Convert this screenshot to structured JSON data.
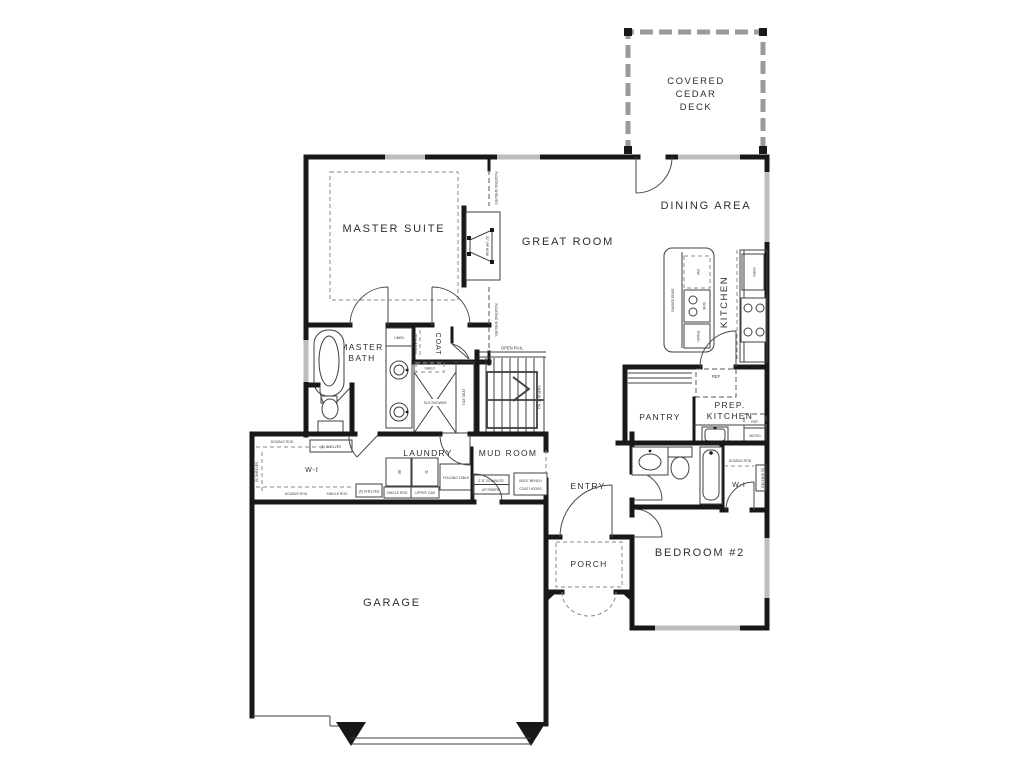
{
  "plan": {
    "rooms": {
      "deck": {
        "lines": [
          "COVERED",
          "CEDAR",
          "DECK"
        ]
      },
      "dining": {
        "label": "DINING AREA"
      },
      "great_room": {
        "label": "GREAT ROOM"
      },
      "master_suite": {
        "label": "MASTER SUITE"
      },
      "kitchen": {
        "label": "KITCHEN"
      },
      "prep_kitchen": {
        "lines": [
          "PREP.",
          "KITCHEN"
        ]
      },
      "pantry": {
        "label": "PANTRY"
      },
      "entry": {
        "label": "ENTRY"
      },
      "porch": {
        "label": "PORCH"
      },
      "mud_room": {
        "label": "MUD ROOM"
      },
      "laundry": {
        "label": "LAUNDRY"
      },
      "master_bath": {
        "lines": [
          "MASTER",
          "BATH"
        ]
      },
      "coat": {
        "label": "COAT"
      },
      "master_closet": {
        "label": "W-I"
      },
      "bed2_closet": {
        "label": "W-I"
      },
      "bedroom2": {
        "label": "BEDROOM #2"
      },
      "garage": {
        "label": "GARAGE"
      }
    },
    "annotations": {
      "floating_shelves": "FLOATING SHELVES",
      "fireplace": "52\" OP HDW",
      "oven": "OVEN",
      "dw": "DW",
      "sink": "SINK",
      "trash": "TRASH",
      "raised_edge": "RAISED EDGE",
      "ref": "REF",
      "ref2": "REF.",
      "micro": "MICRO",
      "open_rail": "OPEN RAIL",
      "stairs_note": "DN 16 RISERS",
      "tile_shower": "TILE SHOWER",
      "tile_seat": "TILE SEAT",
      "shelf": "SHELF",
      "linen": "LINEN",
      "single_rod": "SINGLE ROD",
      "double_rod": "DOUBLE ROD",
      "upper_cab": "UPPER CAB",
      "folding_table": "FOLDING TABLE",
      "five_shelves": "(5) SHELVES",
      "washer": "W",
      "dryer": "D",
      "boot_bench": {
        "lines": [
          "BOOT BENCH",
          "COAT HOOKS"
        ]
      },
      "garage_door_note": {
        "lines": [
          "2'-8\" 20-MINUTE",
          "UP RISERS"
        ]
      }
    },
    "colors": {
      "wall": "#181818",
      "window": "#bdbdbd",
      "background": "#ffffff"
    }
  }
}
